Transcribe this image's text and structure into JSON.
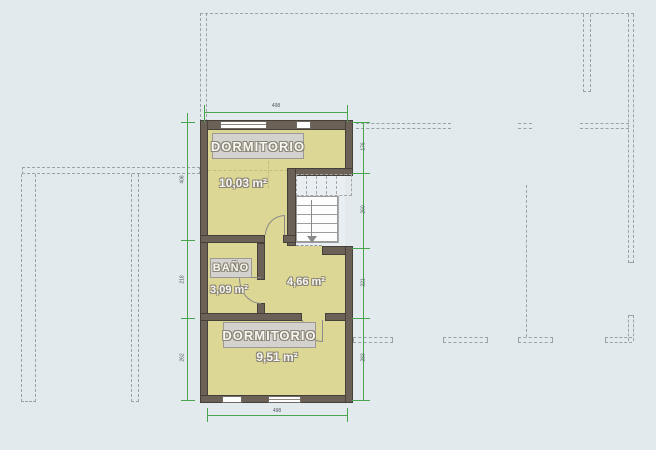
{
  "title": "floor-plan",
  "rooms": {
    "dormitorio_top": {
      "label": "DORMITORIO",
      "area": "10,03 m²"
    },
    "bano": {
      "label": "BAÑO",
      "area": "3,09 m²"
    },
    "hall": {
      "area": "4,66 m²"
    },
    "dormitorio_bottom": {
      "label": "DORMITORIO",
      "area": "9,51 m²"
    }
  },
  "dimensions": {
    "top": "498",
    "bottom": "498",
    "left": [
      "408",
      "218",
      "262"
    ],
    "right": [
      "176",
      "260",
      "221",
      "283"
    ]
  },
  "colors": {
    "background": "#e3eaee",
    "room_fill": "#dcd795",
    "wall": "#6b6157",
    "wall_outline": "#45403a",
    "dimension_green": "#4aa34f",
    "dashed_gray": "#98a3a9",
    "label_box": "#d4d2cf"
  }
}
